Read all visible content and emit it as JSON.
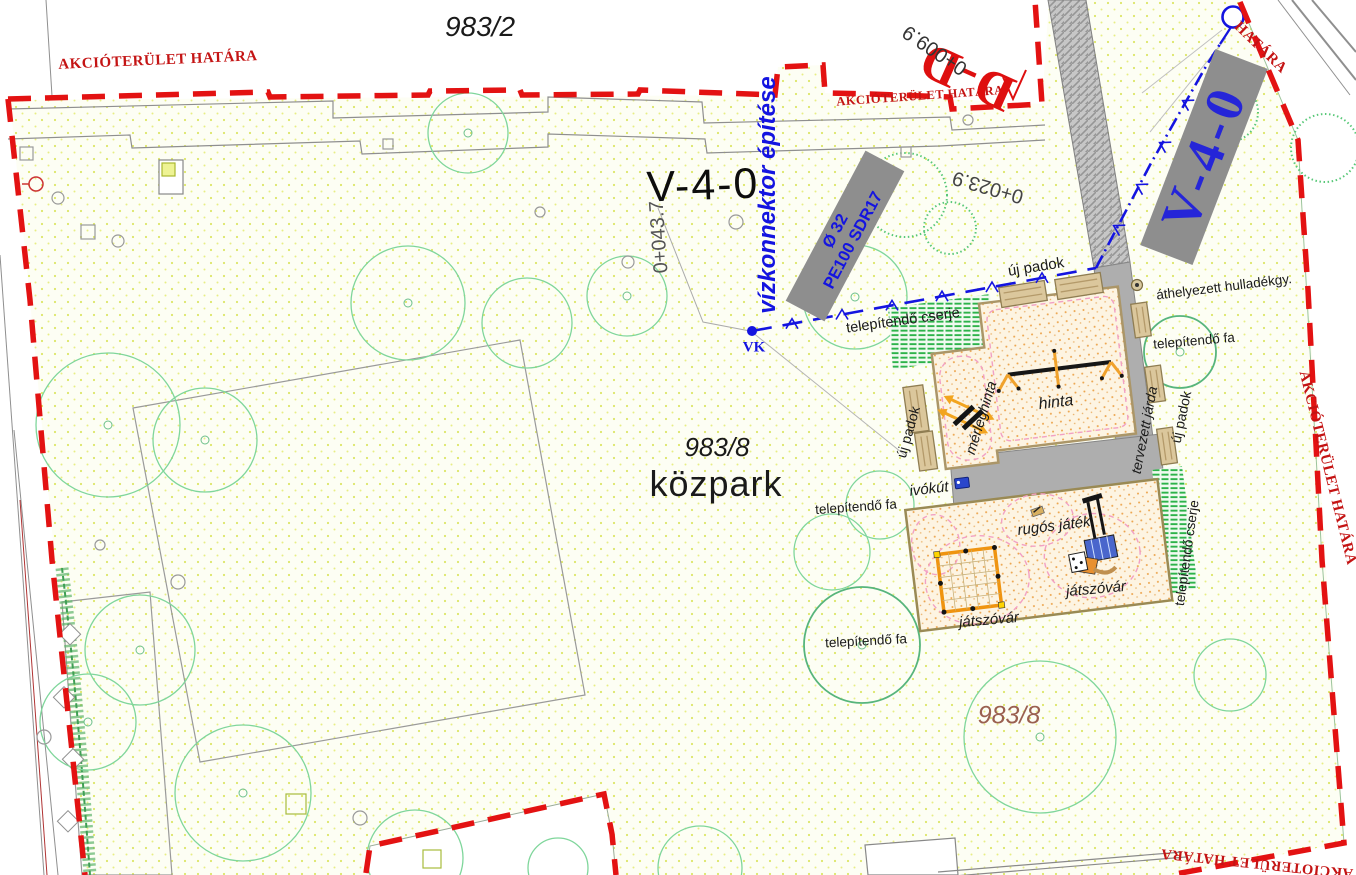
{
  "plan_labels": {
    "parcel_top": "983/2",
    "parcel_main": "983/8",
    "parcel_main_name": "közpark",
    "parcel_bottom": "983/8",
    "boundary": "AKCIÓTERÜLET HATÁRA",
    "boundary_partial": "HATÁRA",
    "water_connector": "vízkonnektor építése",
    "pipe_diameter": "Ø 32",
    "pipe_spec": "PE100 SDR17",
    "water_node": "VK",
    "section_v": "V-4-0",
    "section_d": "D-D",
    "chainage_1": "0+009.9",
    "chainage_2": "0+023.9",
    "chainage_3": "0+043.7",
    "new_benches": "új padok",
    "relocated_bin": "áthelyezett hulladékgy.",
    "shrubs_to_plant": "telepítendő cserje",
    "tree_to_plant": "telepítendő fa",
    "swing": "hinta",
    "seesaw": "mérleghinta",
    "planned_walkway": "tervezett járda",
    "drinking_fountain": "ivókút",
    "spring_toy": "rugós játék",
    "play_castle": "játszóvár"
  },
  "colors": {
    "boundary_red": "#e31212",
    "water_blue": "#1414e0",
    "tree_green": "#7fd69b",
    "shrub_green": "#2db34a",
    "walkway_gray": "#aeaeae",
    "bench_tan": "#d9c49a",
    "play_area_dot": "#eca44c",
    "park_dot": "#dce668",
    "parcel_brown": "#9a6050"
  }
}
